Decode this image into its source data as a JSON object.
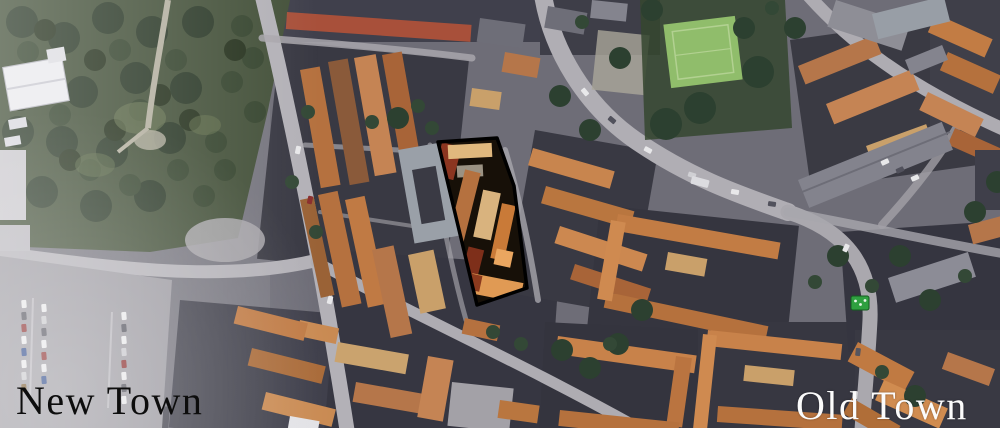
{
  "map": {
    "kind": "aerial-satellite-photo",
    "labels": {
      "new_town": "New Town",
      "old_town": "Old Town"
    },
    "highlight": {
      "name": "highlighted building block",
      "outline_color": "#000000"
    },
    "marker": {
      "name": "green sign marker",
      "color": "#2fa040",
      "border": "#145c20"
    },
    "colors": {
      "label_new": "#0d0d0d",
      "label_old": "#fbfbfb"
    }
  }
}
